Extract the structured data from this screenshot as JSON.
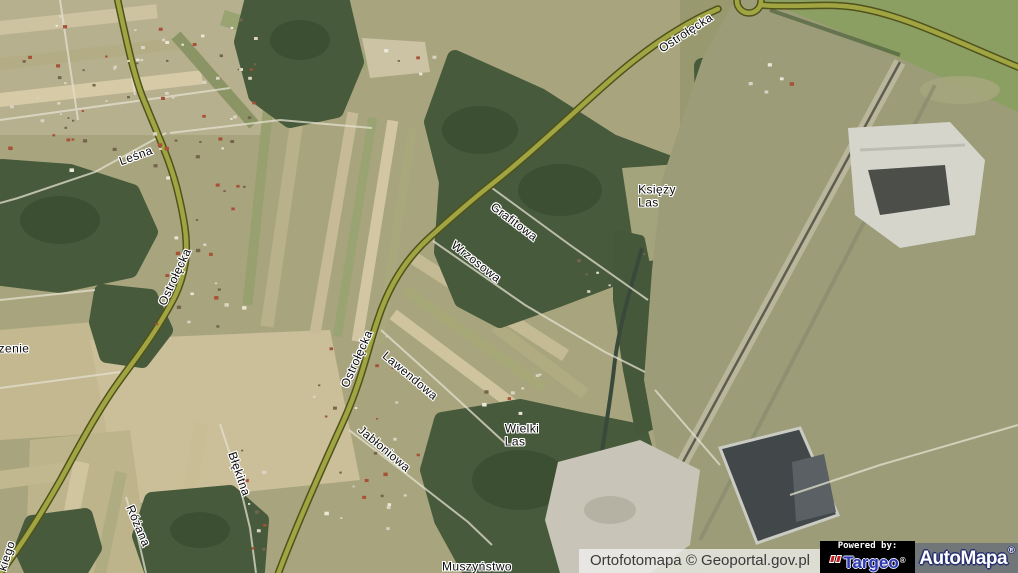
{
  "map": {
    "labels": [
      {
        "id": "ostrolecka-ne",
        "text": "Ostrołęcka",
        "x": 686,
        "y": 33,
        "rot": -33
      },
      {
        "id": "lesna",
        "text": "Leśna",
        "x": 136,
        "y": 156,
        "rot": -20
      },
      {
        "id": "ostrolecka-w",
        "text": "Ostrołęcka",
        "x": 175,
        "y": 277,
        "rot": -65
      },
      {
        "id": "grafitowa",
        "text": "Grafitowa",
        "x": 514,
        "y": 222,
        "rot": 37
      },
      {
        "id": "wrzosowa",
        "text": "Wrzosowa",
        "x": 476,
        "y": 262,
        "rot": 38
      },
      {
        "id": "ksiezy-las",
        "text": "Księży\nLas",
        "x": 657,
        "y": 196,
        "rot": 0
      },
      {
        "id": "ostrolecka-c",
        "text": "Ostrołęcka",
        "x": 357,
        "y": 359,
        "rot": -66
      },
      {
        "id": "lawendowa",
        "text": "Lawendowa",
        "x": 410,
        "y": 376,
        "rot": 40
      },
      {
        "id": "jabloniowa",
        "text": "Jabłoniowa",
        "x": 384,
        "y": 449,
        "rot": 40
      },
      {
        "id": "wielki-las",
        "text": "Wielki\nLas",
        "x": 522,
        "y": 435,
        "rot": 0
      },
      {
        "id": "blekitna",
        "text": "Błękitna",
        "x": 239,
        "y": 474,
        "rot": 71
      },
      {
        "id": "rozana",
        "text": "Różana",
        "x": 138,
        "y": 526,
        "rot": 67
      },
      {
        "id": "zenie",
        "text": "zenie",
        "x": 14,
        "y": 349,
        "rot": 0
      },
      {
        "id": "kiego",
        "text": "kiego",
        "x": 7,
        "y": 556,
        "rot": -72
      },
      {
        "id": "muszynstwo",
        "text": "Muszyństwo",
        "x": 477,
        "y": 567,
        "rot": 0
      }
    ]
  },
  "attribution": {
    "label": "Ortofotomapa © Geoportal.gov.pl"
  },
  "branding": {
    "powered_by": "Powered by:",
    "targeo_name": "Targeo",
    "targeo_reg": "®",
    "automapa_name": "AutoMapa",
    "automapa_reg": "®"
  },
  "colors": {
    "road_fill": "#a0a441",
    "road_casing": "#50521d",
    "label_halo": "#ffffff",
    "targeo_blue": "#2b38ad",
    "automapa_outline": "#27306e",
    "attribution_text": "#3a3a3a"
  }
}
